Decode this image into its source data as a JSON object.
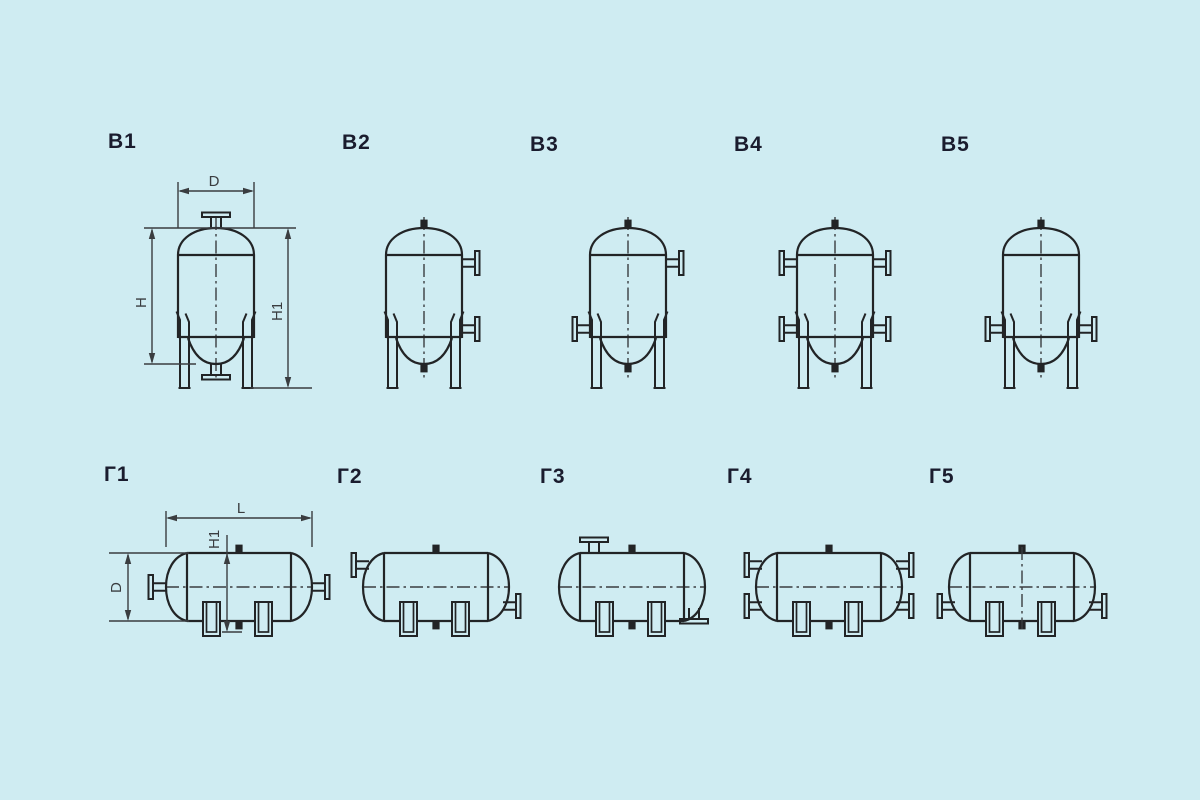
{
  "page": {
    "background_color": "#cfecf2",
    "line_color": "#222426",
    "dim_color": "#3a3d40",
    "label_color": "#1a1c2e"
  },
  "figures": [
    {
      "label": "В1",
      "orientation": "vertical",
      "dims": {
        "D": "D",
        "H": "H",
        "H1": "H1"
      }
    },
    {
      "label": "В2",
      "orientation": "vertical"
    },
    {
      "label": "В3",
      "orientation": "vertical"
    },
    {
      "label": "В4",
      "orientation": "vertical"
    },
    {
      "label": "В5",
      "orientation": "vertical"
    },
    {
      "label": "Г1",
      "orientation": "horizontal",
      "dims": {
        "L": "L",
        "H1": "H1",
        "D": "D"
      }
    },
    {
      "label": "Г2",
      "orientation": "horizontal"
    },
    {
      "label": "Г3",
      "orientation": "horizontal"
    },
    {
      "label": "Г4",
      "orientation": "horizontal"
    },
    {
      "label": "Г5",
      "orientation": "horizontal"
    }
  ]
}
